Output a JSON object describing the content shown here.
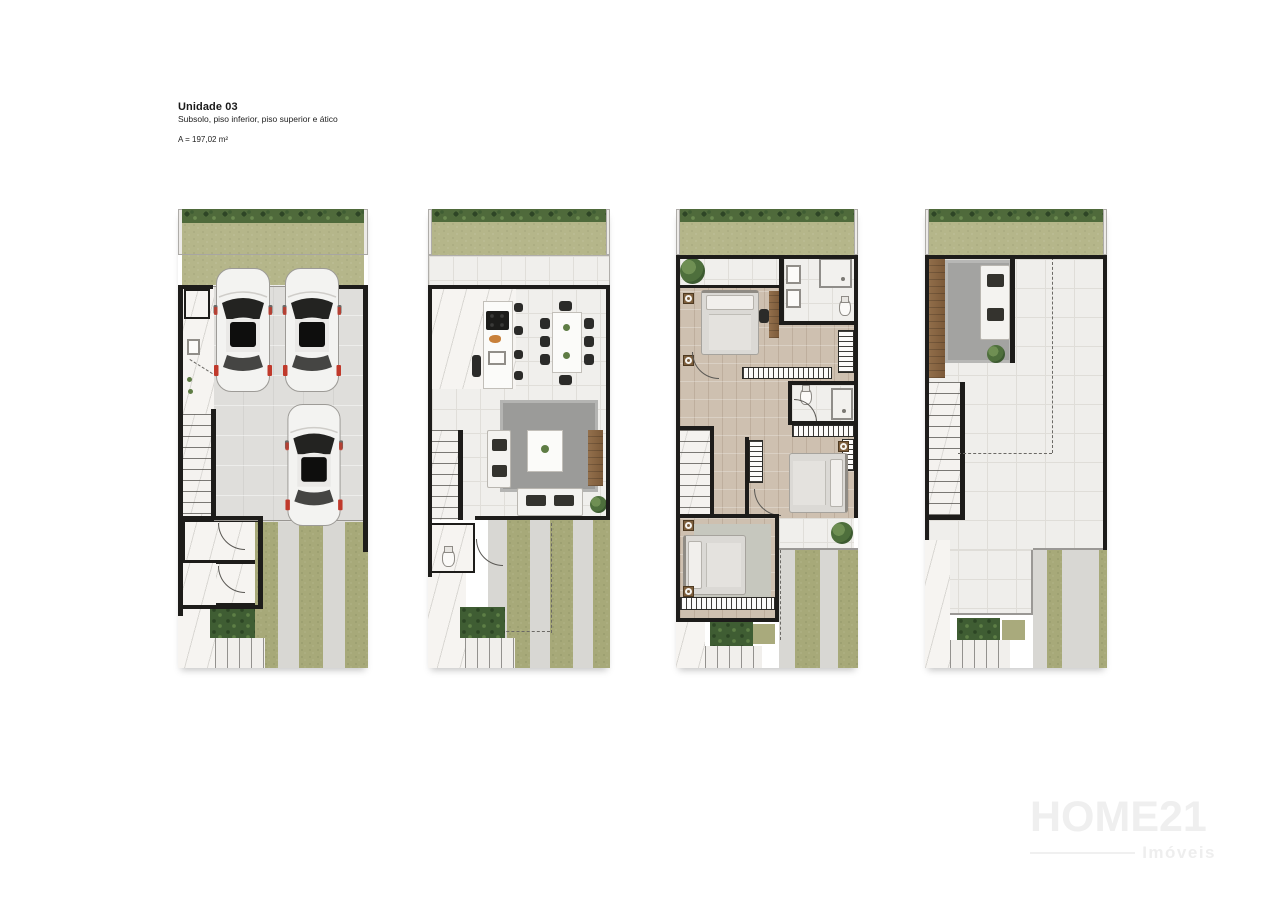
{
  "header": {
    "title": "Unidade 03",
    "subtitle": "Subsolo, piso inferior, piso superior e ático",
    "area": "A = 197,02 m²"
  },
  "floors": [
    {
      "id": "subsolo",
      "label": "Subsolo"
    },
    {
      "id": "piso-inferior",
      "label": "Piso inferior"
    },
    {
      "id": "piso-superior",
      "label": "Piso superior"
    },
    {
      "id": "atico",
      "label": "Ático"
    }
  ],
  "watermark": {
    "brand": "HOME21",
    "tagline": "Imóveis"
  },
  "colors": {
    "background": "#ffffff",
    "wall": "#1d1c1a",
    "shrub_band": "#4f6a3b",
    "lawn": "#b5b68a",
    "grass_strip": "#a7a979",
    "hedge_patch": "#3f5d33",
    "garage_floor": "#dfdedb",
    "driveway": "#d8d7d3",
    "tile_floor": "#f0efec",
    "marble": "#f6f4f1",
    "bedroom_floor": "#cec0b0",
    "rug": "#9b9b99",
    "wood": "#8a6746",
    "car_accent": "#c0392b"
  }
}
